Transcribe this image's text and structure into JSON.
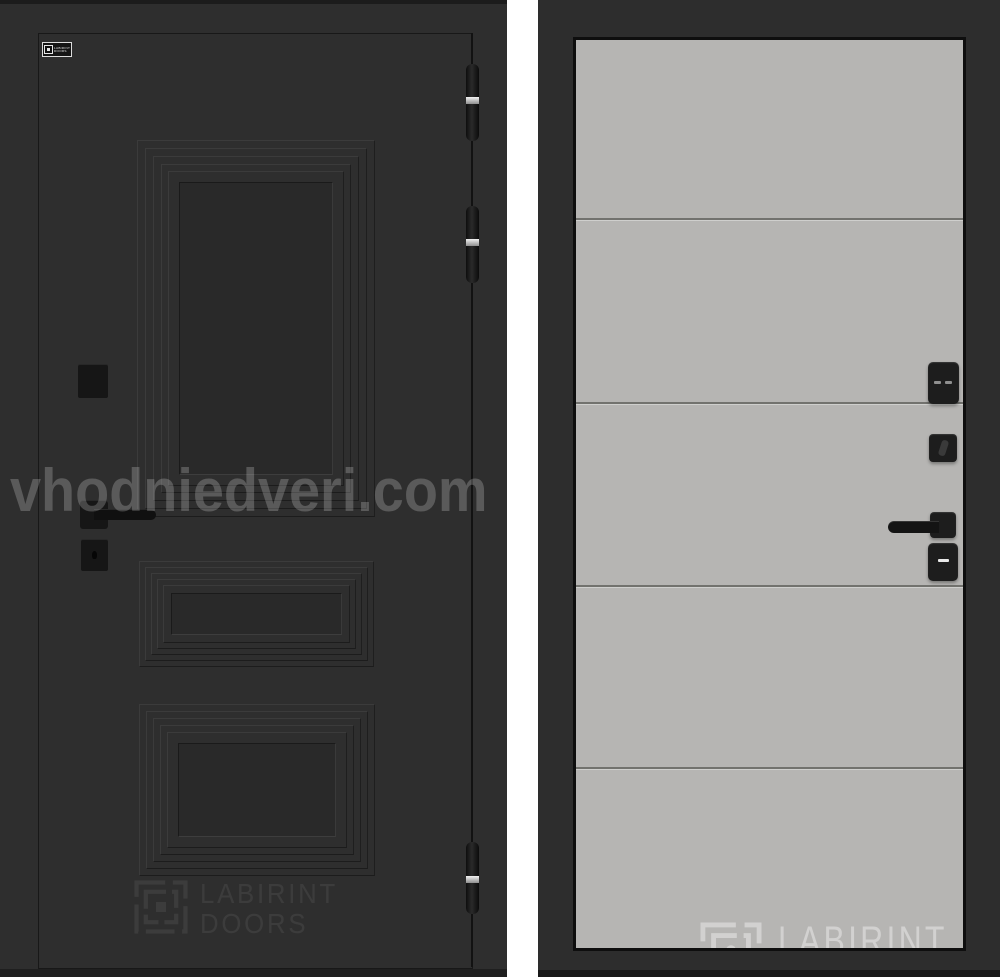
{
  "watermarks": {
    "site_text": "vhodniedveri.com",
    "brand_line1": "LABIRINT",
    "brand_line2": "DOORS"
  },
  "brand_plate": {
    "line1": "LABIRINT",
    "line2": "DOORS"
  },
  "left_photo": {
    "description": "dark charcoal entry door with three raised molded panels, black square hardware and three hinges",
    "colors": {
      "wall": "#2e2e2e",
      "panel_field": "#292929",
      "hardware": "#161616",
      "hinge_ring": "#d6d6d6",
      "site_watermark": "rgba(255,255,255,0.21)",
      "brand_watermark": "rgba(255,255,255,0.07)"
    }
  },
  "right_photo": {
    "description": "light gray flush door panel with four horizontal grooves and black square hardware",
    "colors": {
      "frame": "#2d2d2d",
      "slab": "#b6b5b3",
      "groove": "#72726e",
      "hardware": "#1d1d1d",
      "brand_watermark": "rgba(255,255,255,0.38)"
    }
  },
  "divider": {
    "color": "#ffffff"
  }
}
